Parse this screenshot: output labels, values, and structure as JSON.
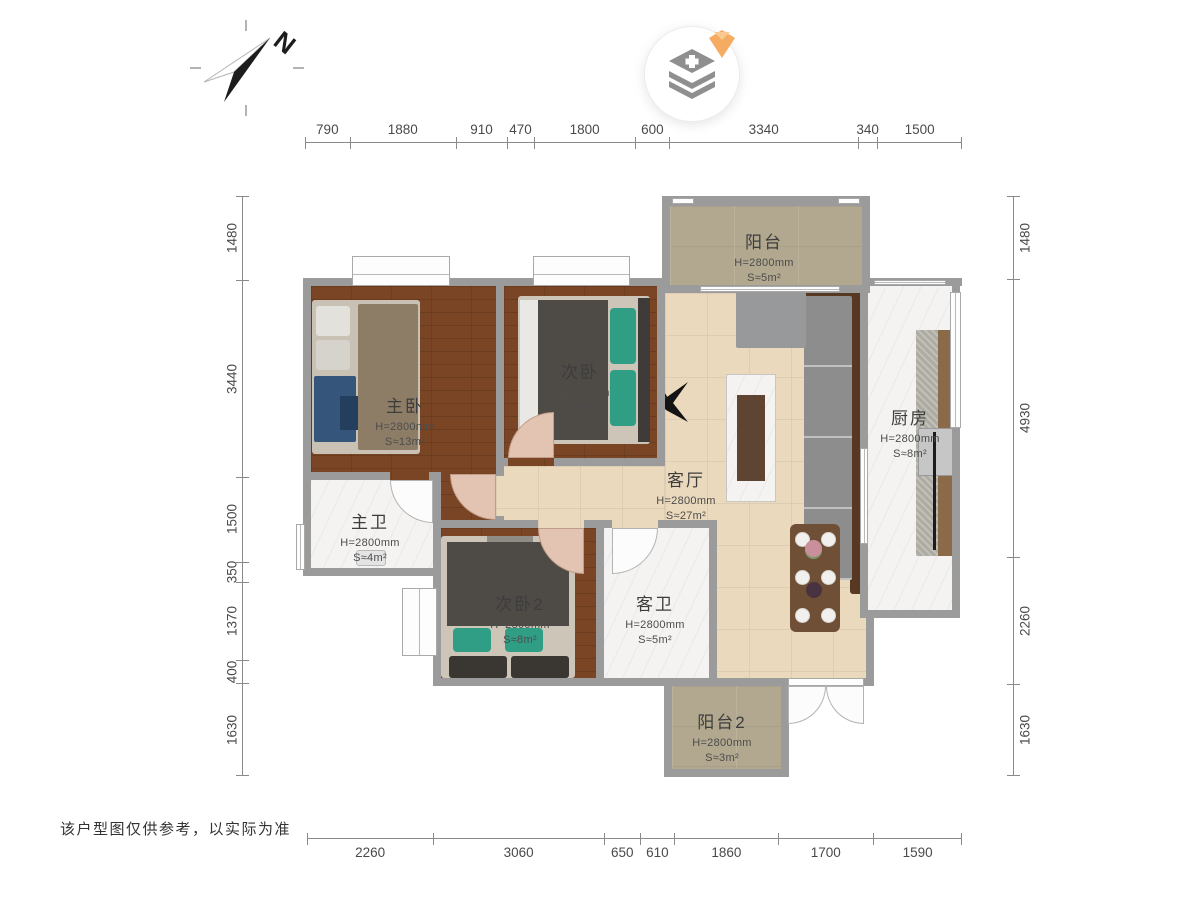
{
  "meta": {
    "disclaimer": "该户型图仅供参考，以实际为准"
  },
  "compass": {
    "label": "N"
  },
  "rooms": [
    {
      "id": "balcony",
      "name": "阳台",
      "height": "H=2800mm",
      "area": "S≈5m²"
    },
    {
      "id": "master-bedroom",
      "name": "主卧",
      "height": "H=2800mm",
      "area": "S≈13m²"
    },
    {
      "id": "bedroom-2",
      "name": "次卧",
      "height": "H=2800mm",
      "area": "S≈9m²"
    },
    {
      "id": "kitchen",
      "name": "厨房",
      "height": "H=2800mm",
      "area": "S≈8m²"
    },
    {
      "id": "living-room",
      "name": "客厅",
      "height": "H=2800mm",
      "area": "S≈27m²"
    },
    {
      "id": "master-bath",
      "name": "主卫",
      "height": "H=2800mm",
      "area": "S≈4m²"
    },
    {
      "id": "bedroom-3",
      "name": "次卧2",
      "height": "H=2800mm",
      "area": "S≈8m²"
    },
    {
      "id": "guest-bath",
      "name": "客卫",
      "height": "H=2800mm",
      "area": "S≈5m²"
    },
    {
      "id": "balcony-2",
      "name": "阳台2",
      "height": "H=2800mm",
      "area": "S≈3m²"
    }
  ],
  "dimensions": {
    "top": [
      790,
      1880,
      910,
      470,
      1800,
      600,
      3340,
      340,
      1500
    ],
    "bottom": [
      2260,
      3060,
      650,
      610,
      1860,
      1700,
      1590
    ],
    "left": [
      1480,
      3440,
      1500,
      350,
      1370,
      400,
      1630
    ],
    "right": [
      1480,
      4930,
      2260,
      1630
    ]
  },
  "palette": {
    "wall": "#9b9b9b",
    "wood": "#7a4524",
    "tile": "#ead9bc",
    "marble": "#f4f3f1",
    "balcony": "#b1a88f",
    "door": "#e3c3b1",
    "sofa": "#8d8d8d",
    "sofa_frame": "#563823",
    "bed_dark": "#4e4a46",
    "teal": "#2f9e85",
    "table": "#6f5037",
    "dim": "#4a4a4a",
    "dimline": "#8a8a8a",
    "accent_diamond": "#f5ab62",
    "icon_gray": "#8f8f8f"
  }
}
